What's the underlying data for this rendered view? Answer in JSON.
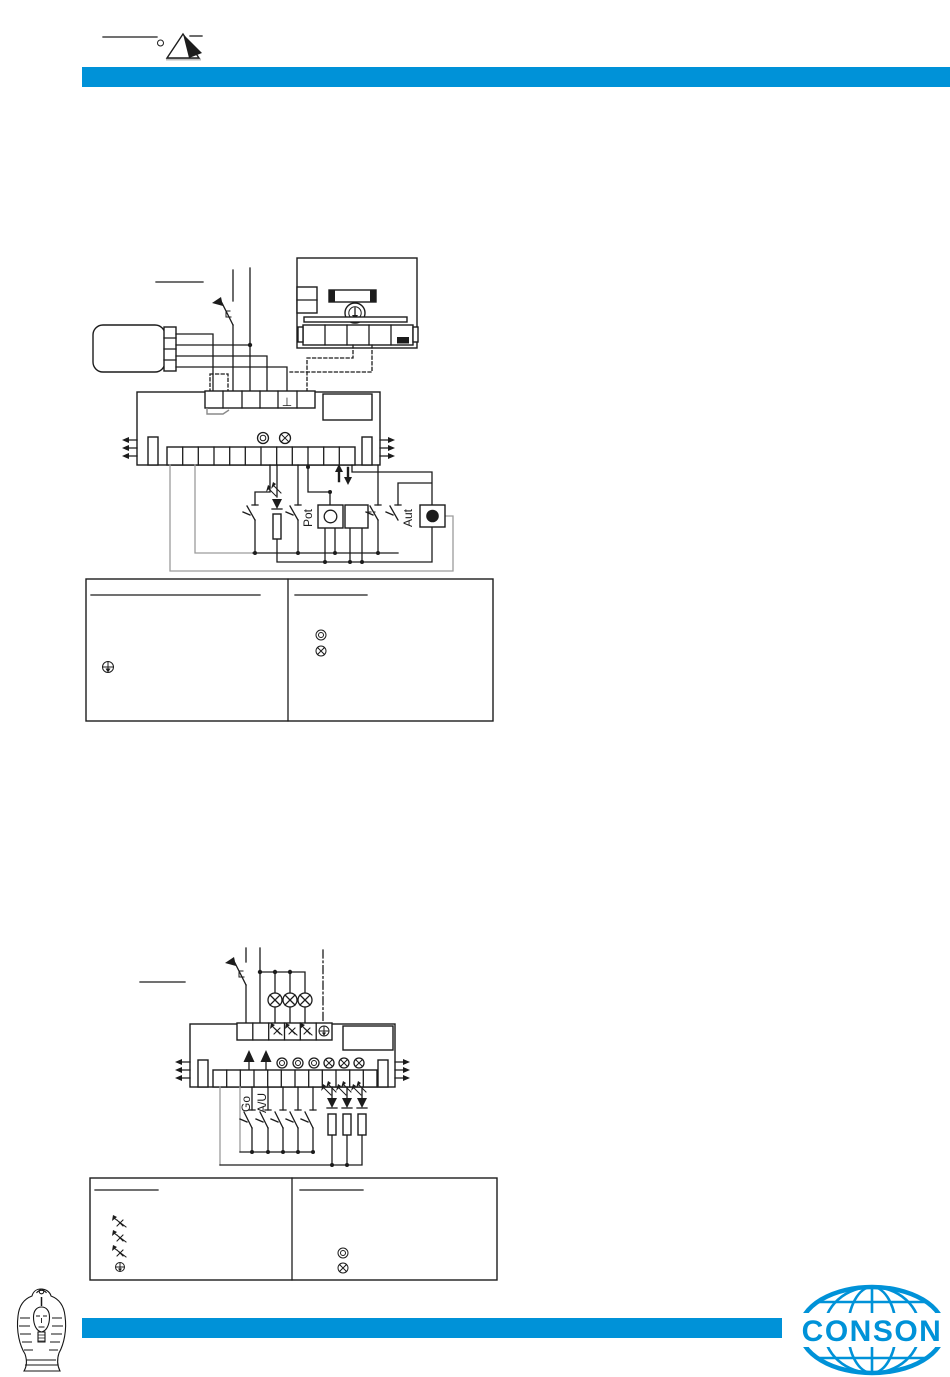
{
  "page": {
    "type": "technical-manual-page",
    "background": "#ffffff"
  },
  "colors": {
    "accent_blue": "#0092d8",
    "ink": "#1c1c1c",
    "wire_gray": "#9c9c9c"
  },
  "header": {
    "logo": "pyramid-logo"
  },
  "diagram1": {
    "name": "wiring-diagram-1",
    "labels": {
      "pot": "Pot",
      "aut": "Aut",
      "ground": "⊥"
    },
    "module_symbols": [
      "double-circle-indicator",
      "crossed-lamp-indicator",
      "up-down-arrows",
      "ground-terminal"
    ],
    "legend": {
      "left_symbols": [
        "knob-arrow-icon"
      ],
      "right_symbols": [
        "double-circle-icon",
        "crossed-lamp-icon"
      ]
    }
  },
  "diagram2": {
    "name": "wiring-diagram-2",
    "labels": {
      "go": "Go",
      "auto_manual": "A/U"
    },
    "module_symbols": [
      "up-arrow-output",
      "up-arrow-output",
      "double-circle-indicator",
      "crossed-lamp-indicator"
    ],
    "legend": {
      "left_symbols": [
        "dimmer-lamp-icon",
        "dimmer-lamp-icon",
        "dimmer-lamp-icon",
        "knob-arrow-icon"
      ],
      "right_symbols": [
        "double-circle-icon",
        "crossed-lamp-icon"
      ]
    }
  },
  "footer": {
    "brand_name": "CONSON",
    "left_logo": "pharaoh-logo",
    "right_logo": "globe-logo"
  }
}
